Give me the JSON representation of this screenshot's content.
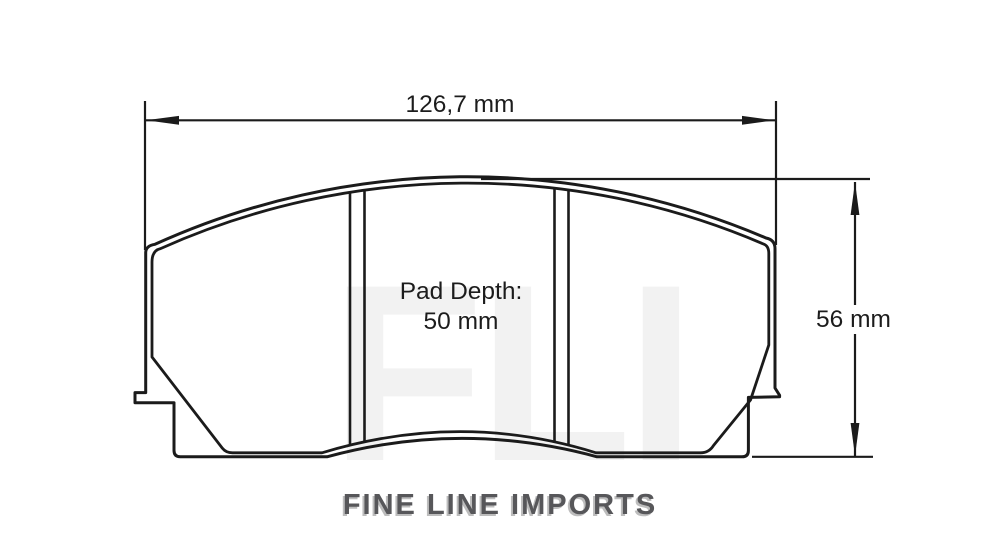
{
  "diagram": {
    "title_context": "brake pad technical drawing",
    "width_dimension_label": "126,7 mm",
    "height_dimension_label": "56 mm",
    "pad_depth_line1": "Pad Depth:",
    "pad_depth_line2": "50 mm"
  },
  "watermark_text": "FLI",
  "footer": {
    "brand_name": "FINE LINE IMPORTS"
  },
  "colors": {
    "background": "#ffffff",
    "line": "#1b1b1b",
    "dimension_text": "#1c1c1c",
    "brand_text": "#57575a",
    "brand_shadow": "#bdbdbd",
    "watermark": "#f2f2f2"
  }
}
